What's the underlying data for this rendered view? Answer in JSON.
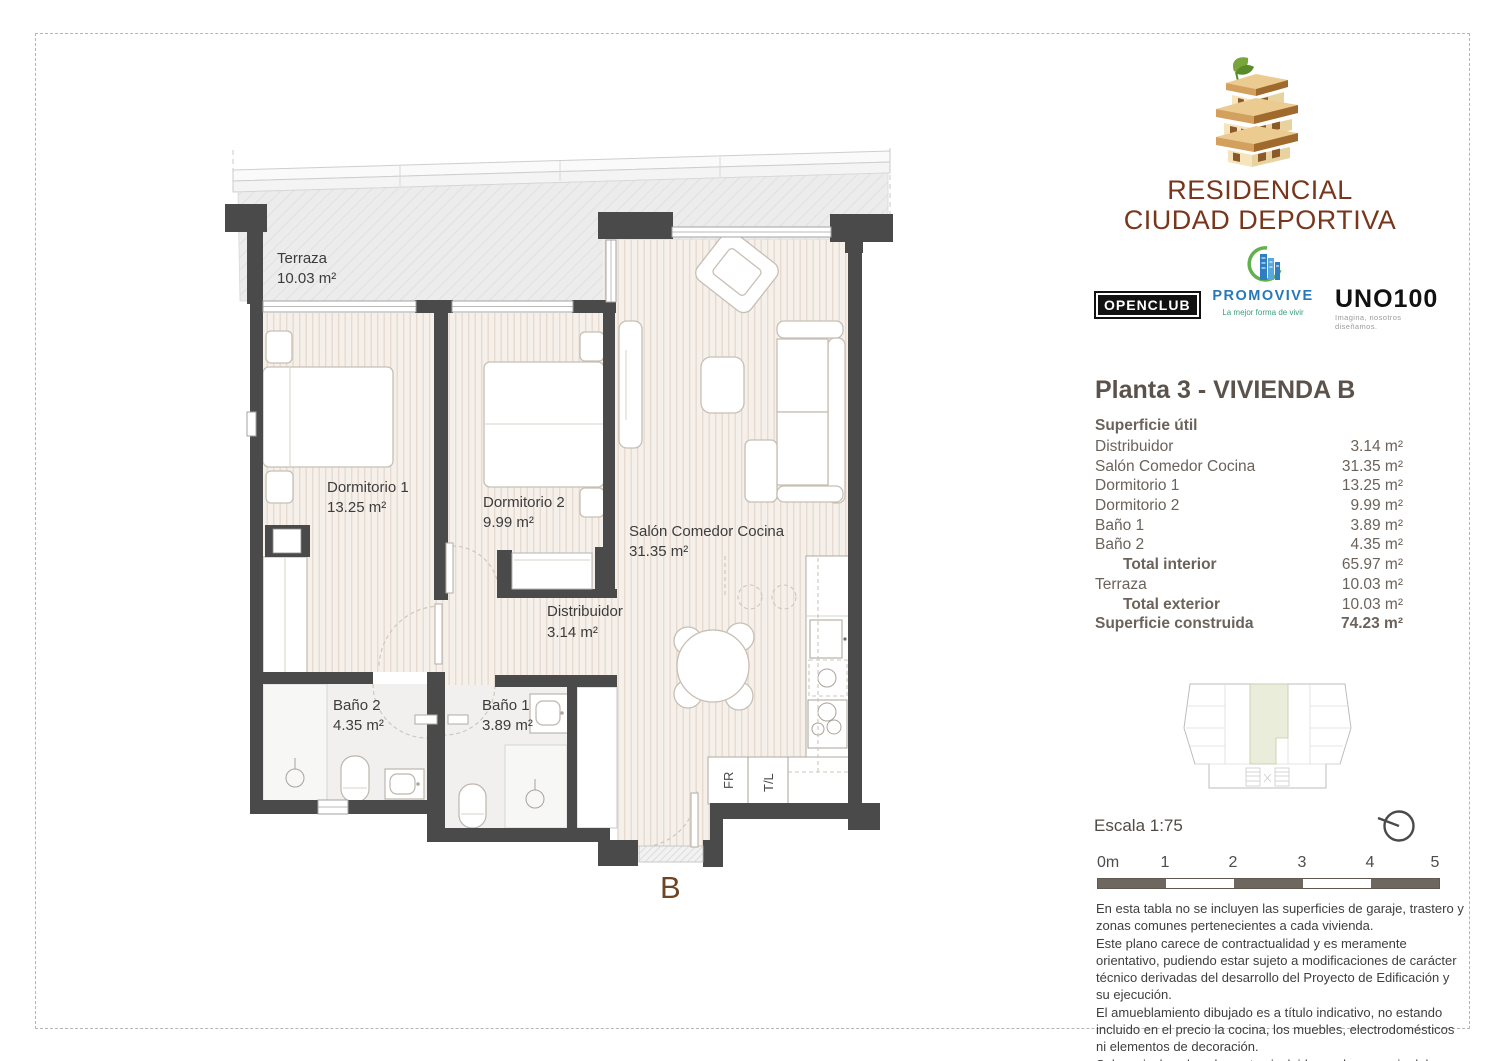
{
  "brand": {
    "line1": "RESIDENCIAL",
    "line2": "CIUDAD DEPORTIVA"
  },
  "partners": {
    "openclub": {
      "name": "OPENCLUB"
    },
    "promovive": {
      "name": "PROMOVIVE",
      "tagline": "La mejor forma de vivir"
    },
    "uno100": {
      "name": "UNO100",
      "tagline": "Imagina, nosotros diseñamos."
    }
  },
  "sheet": {
    "title": "Planta 3 - VIVIENDA B"
  },
  "surface_table": {
    "header": "Superficie útil",
    "rows": [
      {
        "label": "Distribuidor",
        "value": "3.14 m²"
      },
      {
        "label": "Salón Comedor Cocina",
        "value": "31.35 m²"
      },
      {
        "label": "Dormitorio 1",
        "value": "13.25 m²"
      },
      {
        "label": "Dormitorio 2",
        "value": "9.99 m²"
      },
      {
        "label": "Baño 1",
        "value": "3.89 m²"
      },
      {
        "label": "Baño 2",
        "value": "4.35 m²"
      },
      {
        "label": "Total interior",
        "value": "65.97 m²"
      },
      {
        "label": "Terraza",
        "value": "10.03 m²"
      },
      {
        "label": "Total exterior",
        "value": "10.03 m²"
      },
      {
        "label": "Superficie construida",
        "value": "74.23 m²"
      }
    ]
  },
  "plan": {
    "rooms": [
      {
        "name": "Terraza",
        "area": "10.03 m²"
      },
      {
        "name": "Dormitorio 1",
        "area": "13.25 m²"
      },
      {
        "name": "Dormitorio 2",
        "area": "9.99 m²"
      },
      {
        "name": "Salón Comedor Cocina",
        "area": "31.35 m²"
      },
      {
        "name": "Distribuidor",
        "area": "3.14 m²"
      },
      {
        "name": "Baño 2",
        "area": "4.35 m²"
      },
      {
        "name": "Baño 1",
        "area": "3.89 m²"
      }
    ],
    "appliances": {
      "fridge": "FR",
      "laundry": "T/L"
    },
    "unit_letter": "B"
  },
  "scale": {
    "label": "Escala 1:75",
    "ticks": [
      "0m",
      "1",
      "2",
      "3",
      "4",
      "5"
    ]
  },
  "notes": [
    "En esta tabla no se incluyen las superficies de garaje, trastero y zonas comunes pertenecientes a cada vivienda.",
    "Este plano carece de contractualidad y es meramente orientativo, pudiendo estar sujeto a modificaciones de carácter técnico derivadas del desarrollo del Proyecto de Edificación y su ejecución.",
    "El amueblamiento dibujado es a título indicativo, no estando incluido en el precio la cocina, los muebles, electrodomésticos ni elementos de decoración.",
    "Solo se incluye los elementos incluidos en la memoria del Proyecto visado."
  ],
  "colors": {
    "brand_brown": "#78371c",
    "wall": "#4a4a4a",
    "floor_stripe_base": "#f6f0ea",
    "terrace_gray": "#ececec",
    "unit_highlight": "#e9edda",
    "scalebar_dark": "#6e675f",
    "title_text": "#5b534b",
    "table_text": "#6b635b"
  }
}
